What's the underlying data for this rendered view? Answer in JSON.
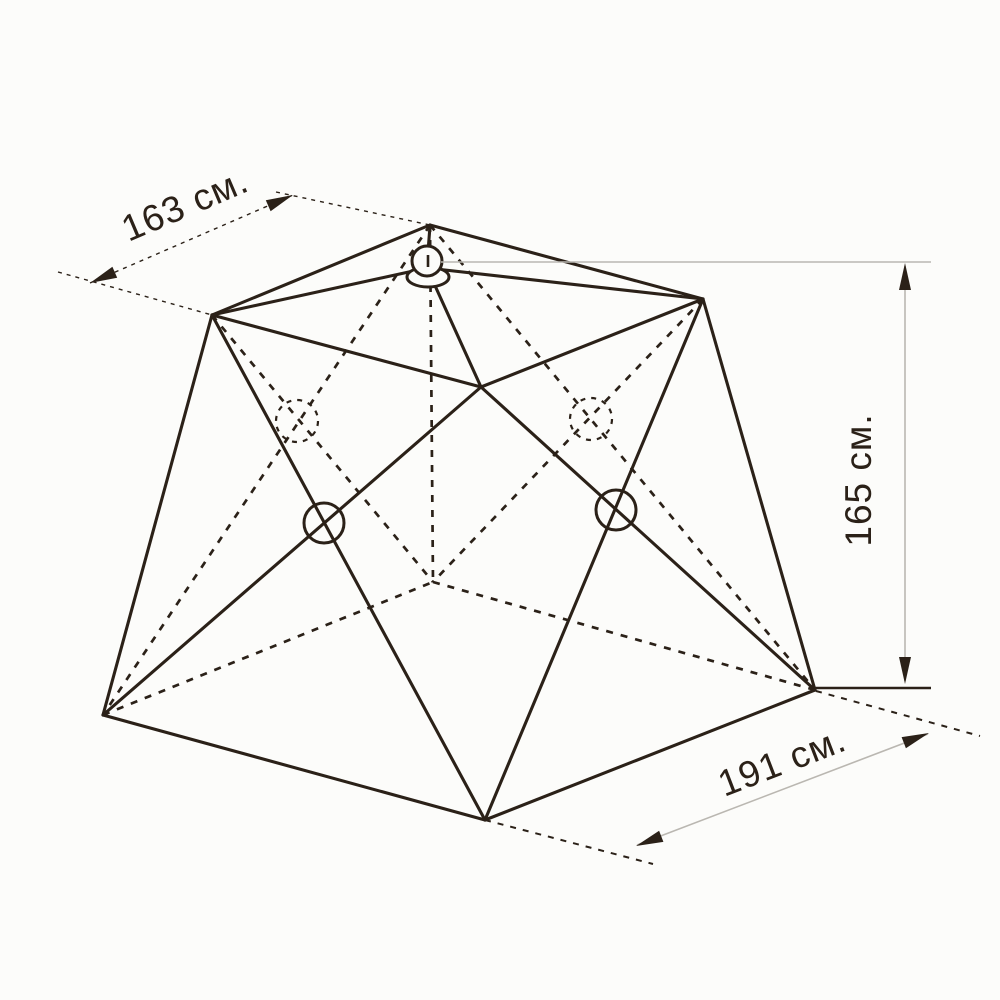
{
  "page": {
    "background": "#fcfcfa"
  },
  "diagram": {
    "type": "technical-dimension-drawing",
    "subject": "pop-up tent frame wireframe",
    "colors": {
      "ink": "#2b2118",
      "faint": "#bab7b1",
      "paper": "#fcfcfa"
    },
    "vertices": {
      "back_top": [
        430,
        225
      ],
      "left_top": [
        212,
        315
      ],
      "right_top": [
        703,
        299
      ],
      "front_top": [
        481,
        387
      ],
      "left_bottom": [
        103,
        715
      ],
      "front_bottom": [
        485,
        820
      ],
      "right_bottom": [
        815,
        690
      ],
      "back_bottom": [
        433,
        582
      ],
      "hub_center": [
        427,
        268
      ]
    },
    "visible_edges": [
      {
        "name": "roof-edge-back-left",
        "from": "back_top",
        "to": "left_top"
      },
      {
        "name": "roof-edge-back-right",
        "from": "back_top",
        "to": "right_top"
      },
      {
        "name": "roof-edge-front-left",
        "from": "left_top",
        "to": "front_top"
      },
      {
        "name": "roof-edge-front-right",
        "from": "front_top",
        "to": "right_top"
      },
      {
        "name": "hub-rib-left",
        "from": "hub_center",
        "to": "left_top"
      },
      {
        "name": "hub-rib-right",
        "from": "hub_center",
        "to": "right_top"
      },
      {
        "name": "hub-rib-front",
        "from": "hub_center",
        "to": "front_top"
      },
      {
        "name": "pole-left",
        "from": "left_top",
        "to": "left_bottom"
      },
      {
        "name": "pole-right",
        "from": "right_top",
        "to": "right_bottom"
      },
      {
        "name": "scissor-left-wall-a",
        "from": "left_top",
        "to": "front_bottom"
      },
      {
        "name": "scissor-left-wall-b",
        "from": "front_top",
        "to": "left_bottom"
      },
      {
        "name": "scissor-right-wall-a",
        "from": "front_top",
        "to": "right_bottom"
      },
      {
        "name": "scissor-right-wall-b",
        "from": "right_top",
        "to": "front_bottom"
      },
      {
        "name": "floor-edge-front-left",
        "from": "left_bottom",
        "to": "front_bottom"
      },
      {
        "name": "floor-edge-front-right",
        "from": "front_bottom",
        "to": "right_bottom"
      }
    ],
    "hidden_edges": [
      {
        "name": "pole-back",
        "from": "back_top",
        "to": "back_bottom"
      },
      {
        "name": "floor-edge-back-left",
        "from": "left_bottom",
        "to": "back_bottom"
      },
      {
        "name": "floor-edge-back-right",
        "from": "back_bottom",
        "to": "right_bottom"
      },
      {
        "name": "scissor-back-left-wall-a",
        "from": "left_top",
        "to": "back_bottom"
      },
      {
        "name": "scissor-back-left-wall-b",
        "from": "back_top",
        "to": "left_bottom"
      },
      {
        "name": "scissor-back-right-wall-a",
        "from": "right_top",
        "to": "back_bottom"
      },
      {
        "name": "scissor-back-right-wall-b",
        "from": "back_top",
        "to": "right_bottom"
      }
    ],
    "hub": {
      "cap": {
        "x1": 430,
        "y1": 226,
        "x2": 428,
        "y2": 252
      },
      "ellipse": {
        "cx": 428,
        "cy": 277,
        "rx": 21,
        "ry": 10
      },
      "circle": {
        "cx": 427,
        "cy": 261,
        "r": 15
      },
      "center_dash": {
        "x1": 428,
        "y1": 255,
        "x2": 428,
        "y2": 267
      }
    },
    "pivots": [
      {
        "name": "left-wall-pivot",
        "cx": 324,
        "cy": 523,
        "r": 20,
        "hidden": false
      },
      {
        "name": "right-wall-pivot",
        "cx": 616,
        "cy": 510,
        "r": 20,
        "hidden": false
      },
      {
        "name": "back-left-wall-pivot",
        "cx": 297,
        "cy": 421,
        "r": 21,
        "hidden": true
      },
      {
        "name": "back-right-wall-pivot",
        "cx": 591,
        "cy": 419,
        "r": 21,
        "hidden": true
      }
    ],
    "dimensions": [
      {
        "id": "top-width",
        "label": "163 см.",
        "value_cm": 163,
        "label_x": 186,
        "label_y": 207,
        "label_rotate": -23,
        "font_px": 37,
        "line": {
          "x1": 90,
          "y1": 283,
          "x2": 293,
          "y2": 195,
          "style": "dash-thin"
        },
        "witness": [
          {
            "x1": 58,
            "y1": 272,
            "x2": 212,
            "y2": 315,
            "style": "dash-thin"
          },
          {
            "x1": 276,
            "y1": 192,
            "x2": 430,
            "y2": 225,
            "style": "dash-thin"
          }
        ],
        "arrows": [
          {
            "x": 90,
            "y": 283,
            "angle": 156.6
          },
          {
            "x": 293,
            "y": 195,
            "angle": -23.4
          }
        ]
      },
      {
        "id": "height",
        "label": "165 см.",
        "value_cm": 165,
        "label_x": 861,
        "label_y": 480,
        "label_rotate": -90,
        "font_px": 37,
        "line": {
          "x1": 905,
          "y1": 266,
          "x2": 905,
          "y2": 681,
          "style": "faint"
        },
        "witness": [
          {
            "x1": 441,
            "y1": 262,
            "x2": 931,
            "y2": 262,
            "style": "faint"
          },
          {
            "x1": 815,
            "y1": 688,
            "x2": 931,
            "y2": 688,
            "style": "ink2"
          }
        ],
        "arrows": [
          {
            "x": 905,
            "y": 263,
            "angle": -90
          },
          {
            "x": 905,
            "y": 684,
            "angle": 90
          }
        ]
      },
      {
        "id": "bottom-width",
        "label": "191 см.",
        "value_cm": 191,
        "label_x": 783,
        "label_y": 764,
        "label_rotate": -21,
        "font_px": 37,
        "line": {
          "x1": 637,
          "y1": 845,
          "x2": 928,
          "y2": 734,
          "style": "faint"
        },
        "witness": [
          {
            "x1": 485,
            "y1": 820,
            "x2": 653,
            "y2": 864,
            "style": "dash2"
          },
          {
            "x1": 816,
            "y1": 691,
            "x2": 980,
            "y2": 736,
            "style": "dash2"
          }
        ],
        "arrows": [
          {
            "x": 636,
            "y": 846,
            "angle": 159
          },
          {
            "x": 929,
            "y": 733,
            "angle": -21
          }
        ]
      }
    ]
  }
}
